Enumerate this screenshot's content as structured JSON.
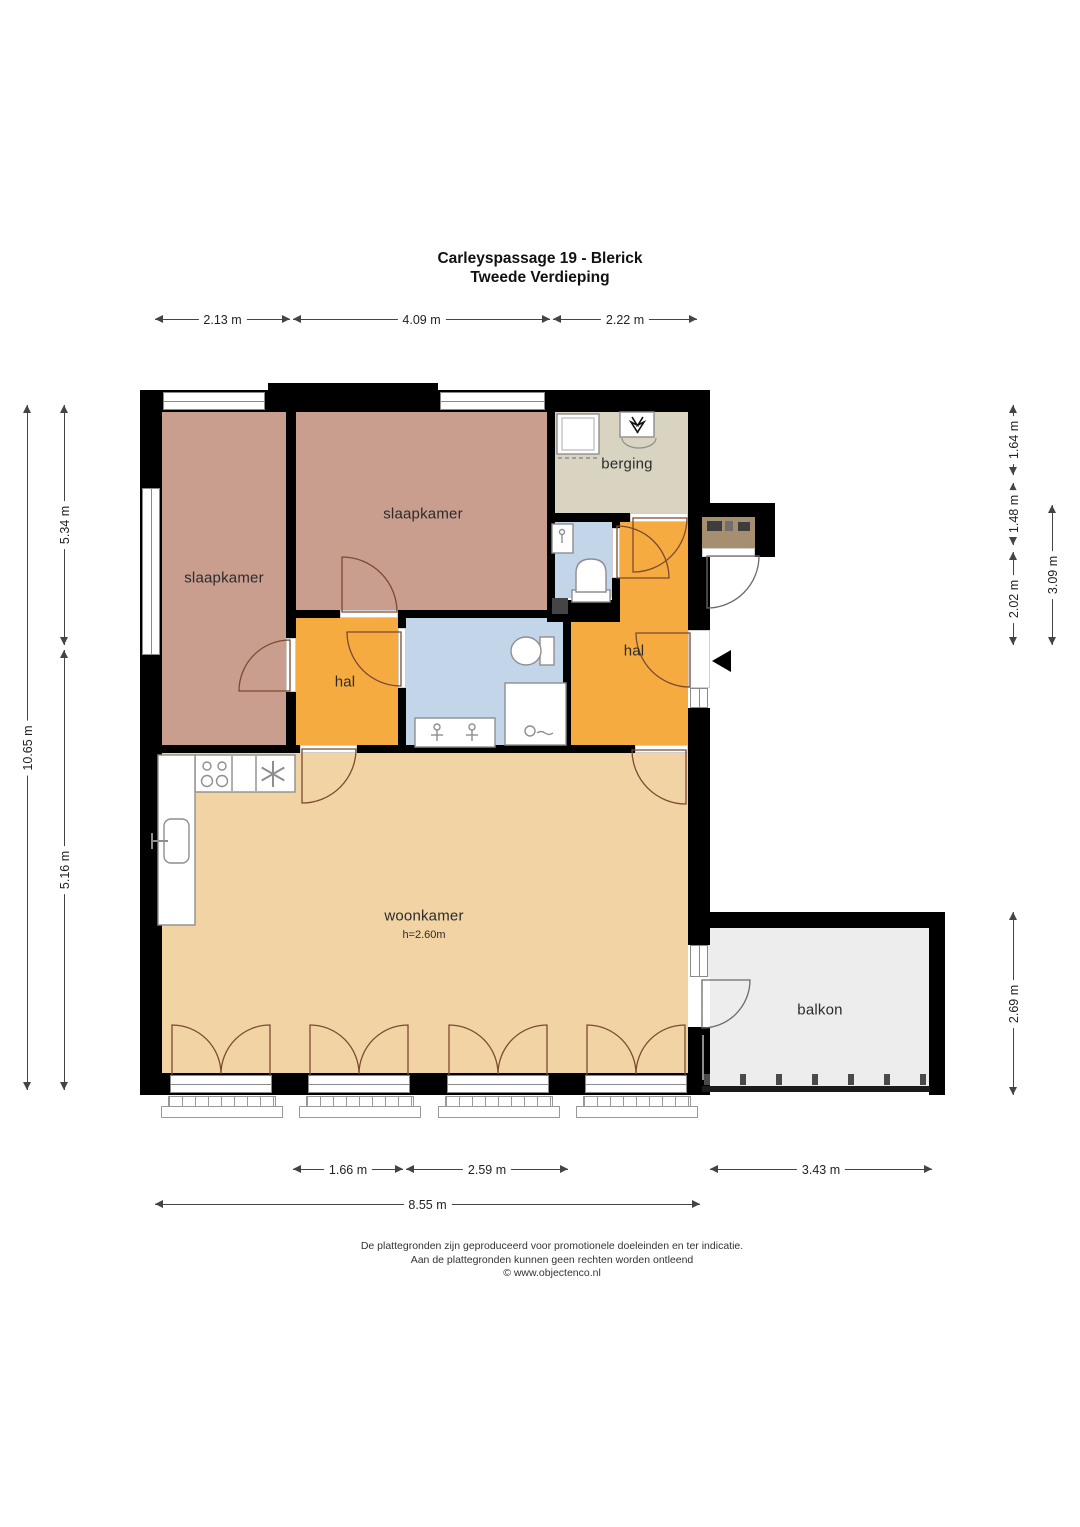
{
  "title": {
    "line1": "Carleyspassage 19 - Blerick",
    "line2": "Tweede Verdieping"
  },
  "rooms": {
    "bedroom_left": "slaapkamer",
    "bedroom_middle": "slaapkamer",
    "storage": "berging",
    "hall_left": "hal",
    "hall_right": "hal",
    "living": "woonkamer",
    "living_ceiling_height": "h=2.60m",
    "balcony": "balkon"
  },
  "dimensions": {
    "top": [
      "2.13 m",
      "4.09 m",
      "2.22 m"
    ],
    "left": [
      "10.65 m",
      "5.34 m",
      "5.16 m"
    ],
    "right": [
      "1.64 m",
      "1.48 m",
      "2.02 m",
      "3.09 m",
      "2.69 m"
    ],
    "bottom": [
      "1.66 m",
      "2.59 m",
      "3.43 m",
      "8.55 m"
    ]
  },
  "footer": {
    "line1": "De plattegronden zijn geproduceerd voor promotionele doeleinden en ter indicatie.",
    "line2": "Aan de plattegronden kunnen geen rechten worden ontleend",
    "line3": "© www.objectenco.nl"
  },
  "icons": [
    "washing-machine-icon",
    "ventilation-icon",
    "toilet-icon",
    "shower-drain-icon",
    "sink-icon",
    "stove-icon",
    "extractor-fan-icon",
    "entrance-arrow-icon",
    "door-swing-arc"
  ],
  "colors": {
    "wall": "#000000",
    "bedroom": "#c99e8f",
    "hall": "#f6ab40",
    "living": "#f2d4a4",
    "bathroom": "#c3d6e9",
    "storage": "#d8d4c1",
    "balcony": "#ededed",
    "entrance_alcove": "#a58f70",
    "door_arc": "#7b4a33"
  }
}
